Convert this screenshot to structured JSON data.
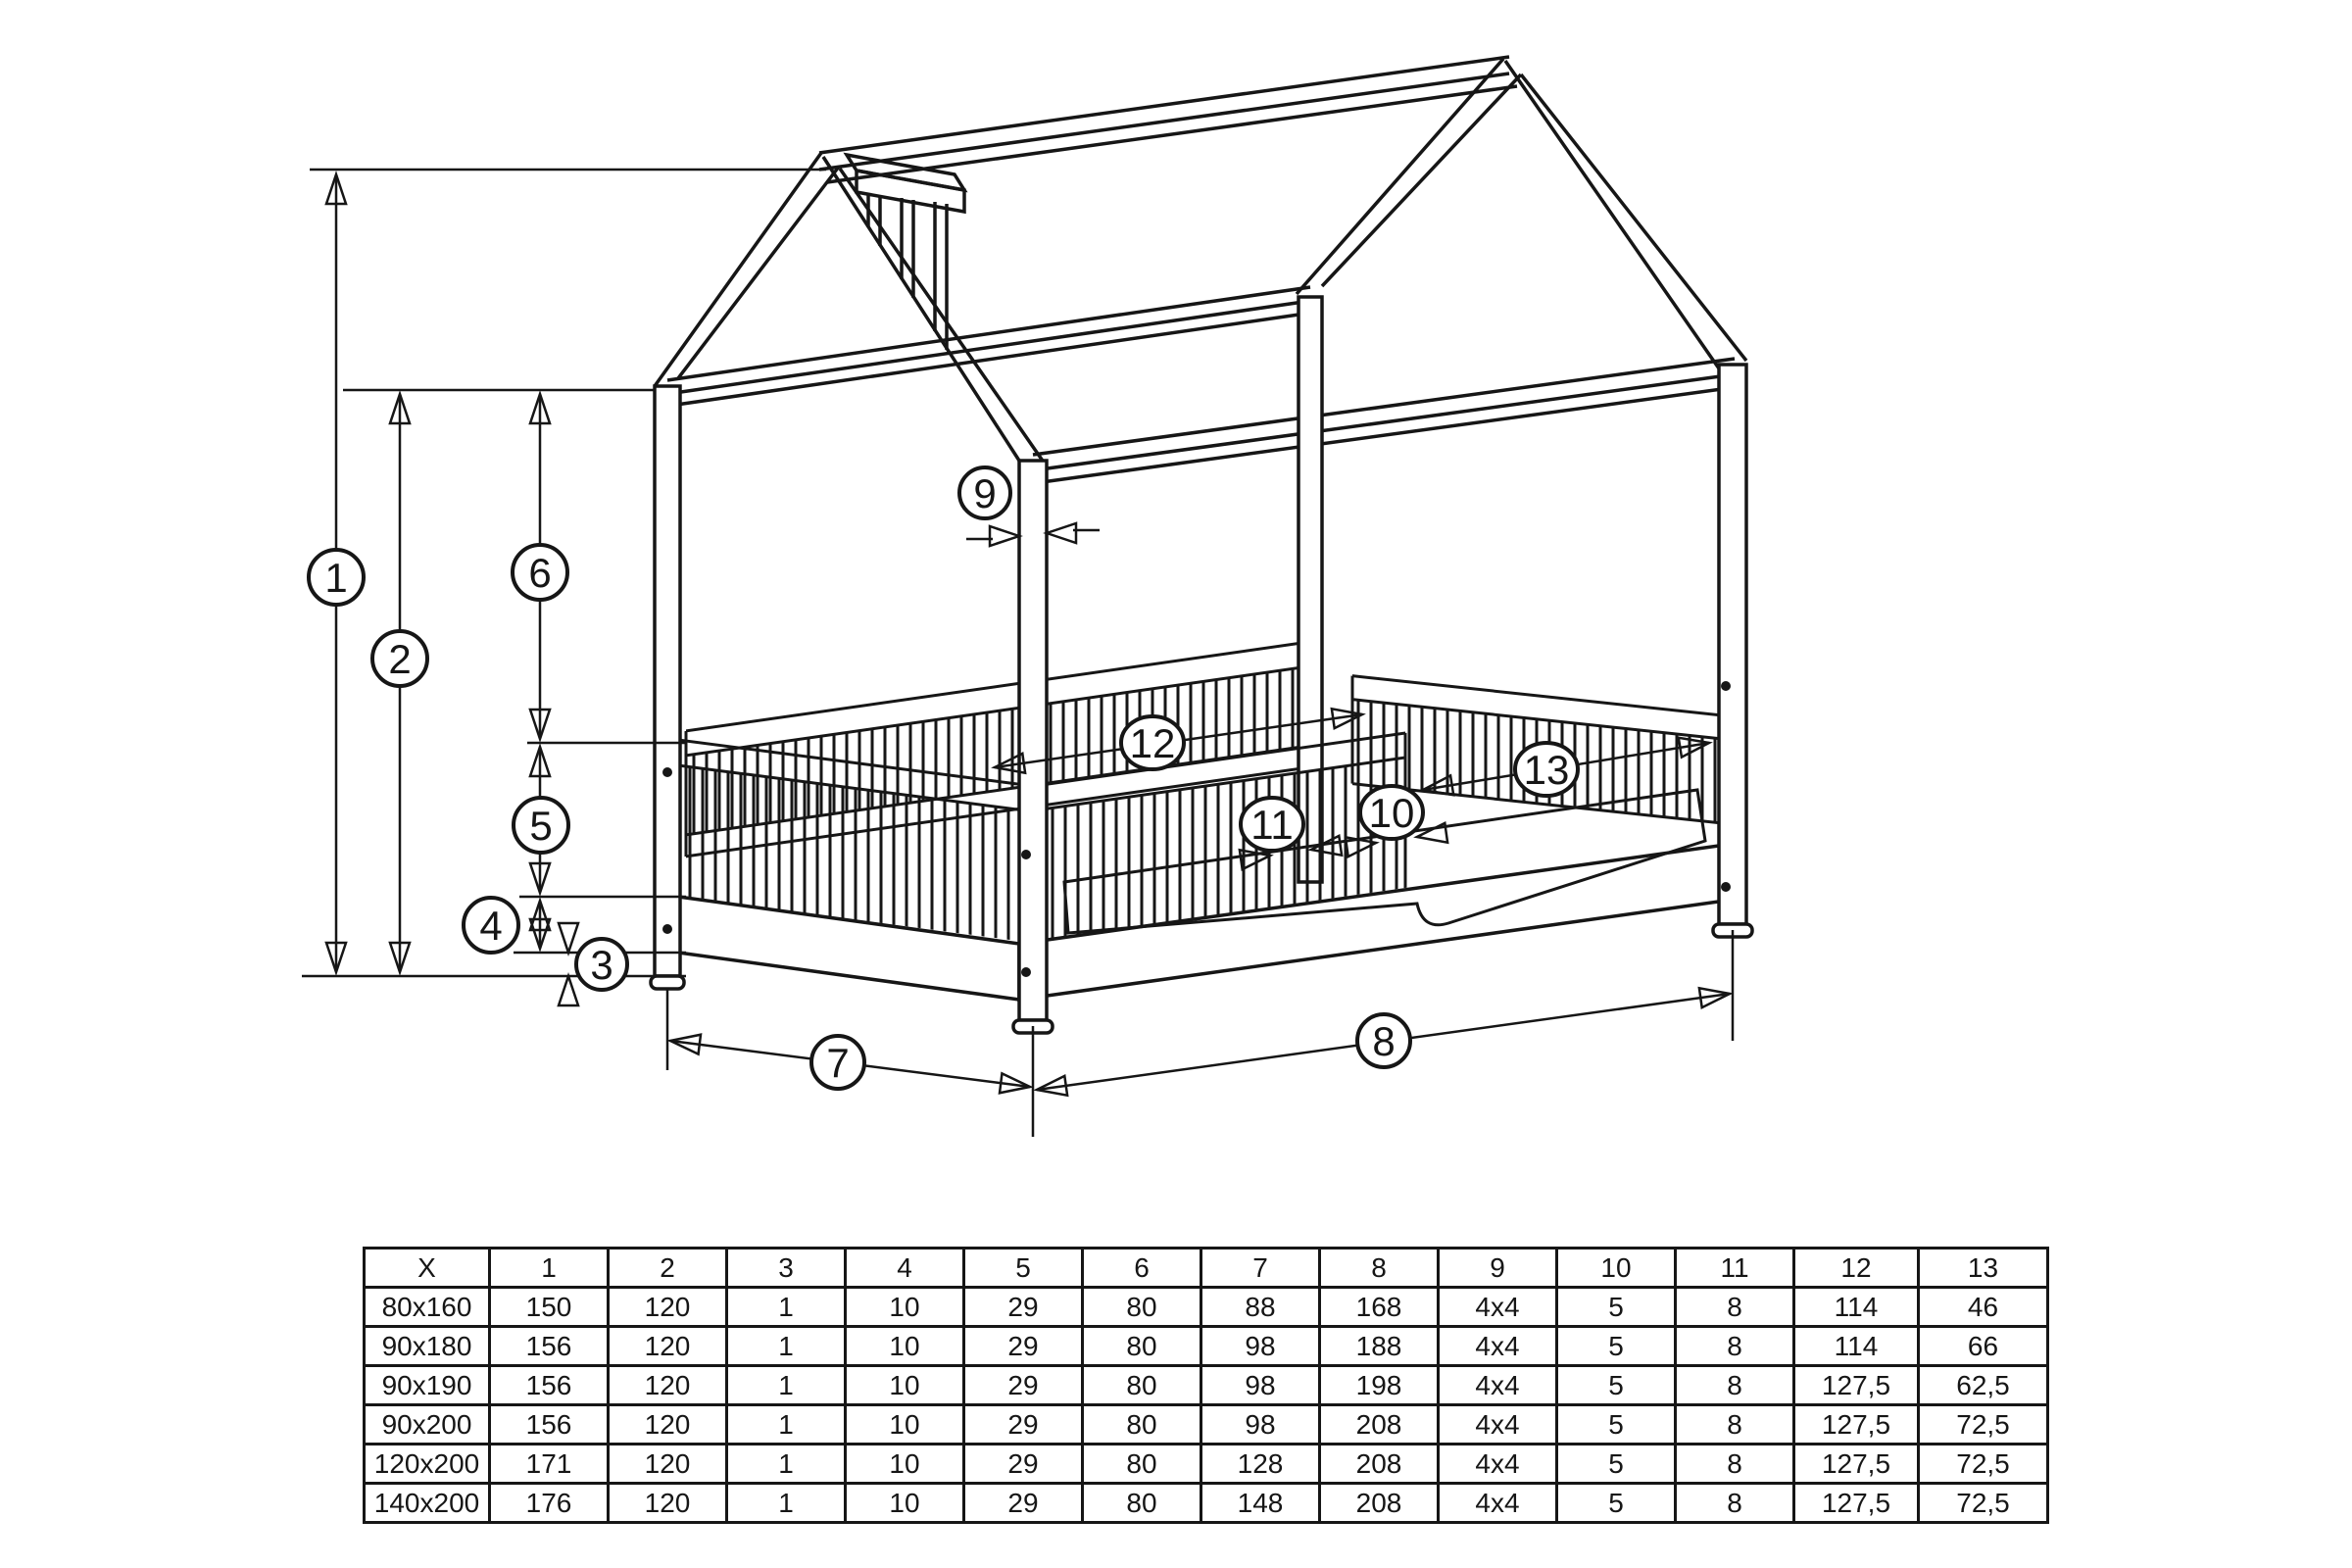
{
  "page": {
    "background": "#ffffff",
    "ink": "#161616"
  },
  "diagram": {
    "kind": "house-bed frame isometric dimension drawing",
    "callouts": [
      {
        "label": "1"
      },
      {
        "label": "2"
      },
      {
        "label": "3"
      },
      {
        "label": "4"
      },
      {
        "label": "5"
      },
      {
        "label": "6"
      },
      {
        "label": "7"
      },
      {
        "label": "8"
      },
      {
        "label": "9"
      },
      {
        "label": "10"
      },
      {
        "label": "11"
      },
      {
        "label": "12"
      },
      {
        "label": "13"
      }
    ]
  },
  "table": {
    "columns": [
      "X",
      "1",
      "2",
      "3",
      "4",
      "5",
      "6",
      "7",
      "8",
      "9",
      "10",
      "11",
      "12",
      "13"
    ],
    "rows": [
      [
        "80x160",
        "150",
        "120",
        "1",
        "10",
        "29",
        "80",
        "88",
        "168",
        "4x4",
        "5",
        "8",
        "114",
        "46"
      ],
      [
        "90x180",
        "156",
        "120",
        "1",
        "10",
        "29",
        "80",
        "98",
        "188",
        "4x4",
        "5",
        "8",
        "114",
        "66"
      ],
      [
        "90x190",
        "156",
        "120",
        "1",
        "10",
        "29",
        "80",
        "98",
        "198",
        "4x4",
        "5",
        "8",
        "127,5",
        "62,5"
      ],
      [
        "90x200",
        "156",
        "120",
        "1",
        "10",
        "29",
        "80",
        "98",
        "208",
        "4x4",
        "5",
        "8",
        "127,5",
        "72,5"
      ],
      [
        "120x200",
        "171",
        "120",
        "1",
        "10",
        "29",
        "80",
        "128",
        "208",
        "4x4",
        "5",
        "8",
        "127,5",
        "72,5"
      ],
      [
        "140x200",
        "176",
        "120",
        "1",
        "10",
        "29",
        "80",
        "148",
        "208",
        "4x4",
        "5",
        "8",
        "127,5",
        "72,5"
      ]
    ]
  }
}
